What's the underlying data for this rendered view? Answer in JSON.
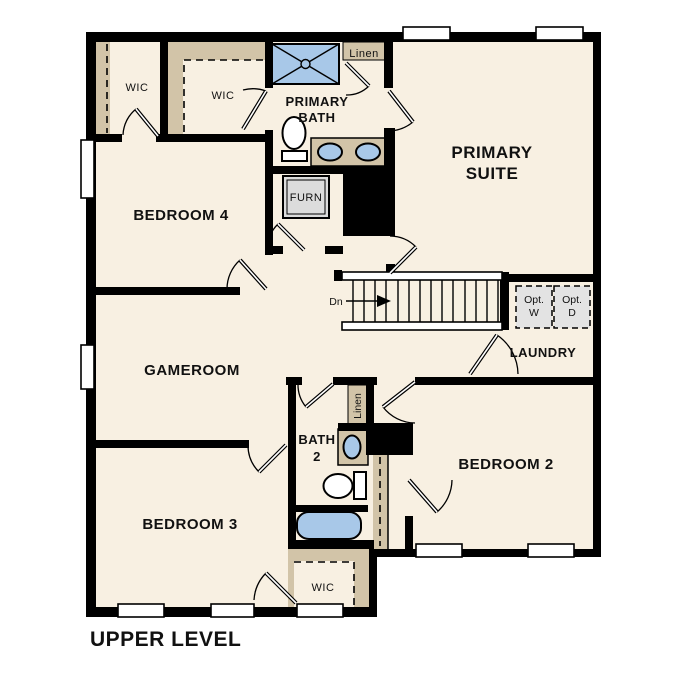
{
  "title": "UPPER LEVEL",
  "colors": {
    "floor": "#f8f0e2",
    "closet_tan": "#d2c4a8",
    "wall_black": "#000000",
    "fixture_blue": "#a8c8e8",
    "appliance_gray": "#dcdcdc",
    "background": "#ffffff"
  },
  "rooms": {
    "wic_top_left": "WIC",
    "wic_top_mid": "WIC",
    "primary_bath_line1": "PRIMARY",
    "primary_bath_line2": "BATH",
    "linen_top": "Linen",
    "primary_suite_line1": "PRIMARY",
    "primary_suite_line2": "SUITE",
    "bedroom4": "BEDROOM 4",
    "furnace": "FURN",
    "gameroom": "GAMEROOM",
    "stairs_direction": "Dn",
    "opt_washer_line1": "Opt.",
    "opt_washer_line2": "W",
    "opt_dryer_line1": "Opt.",
    "opt_dryer_line2": "D",
    "laundry": "LAUNDRY",
    "linen_mid": "Linen",
    "bath2_line1": "BATH",
    "bath2_line2": "2",
    "bedroom2": "BEDROOM 2",
    "bedroom3": "BEDROOM 3",
    "wic_bottom": "WIC"
  }
}
